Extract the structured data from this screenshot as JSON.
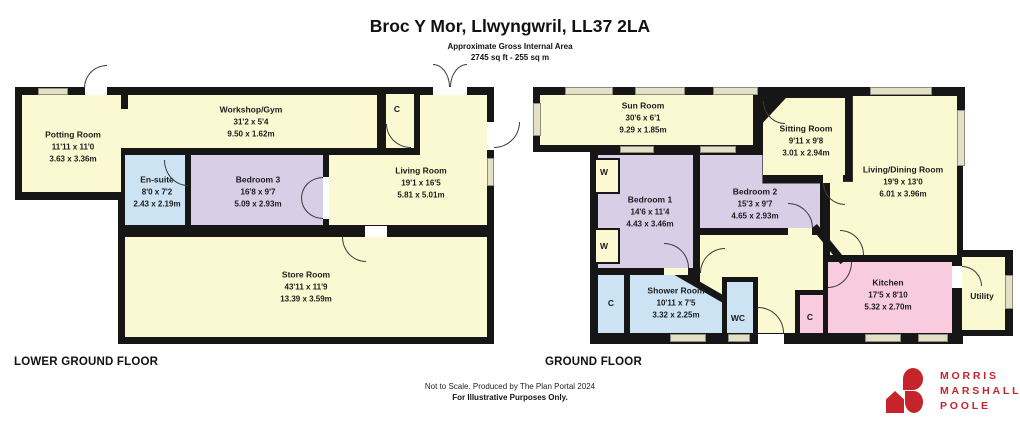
{
  "title": "Broc Y Mor, Llwyngwril, LL37 2LA",
  "subtitle": "Approximate Gross Internal Area",
  "area": "2745 sq ft - 255 sq m",
  "floors": {
    "lower": {
      "label": "LOWER GROUND FLOOR",
      "rooms": {
        "potting": {
          "name": "Potting Room",
          "imperial": "11'11 x 11'0",
          "metric": "3.63 x 3.36m"
        },
        "workshop": {
          "name": "Workshop/Gym",
          "imperial": "31'2 x 5'4",
          "metric": "9.50 x 1.62m"
        },
        "ensuite": {
          "name": "En-suite",
          "imperial": "8'0 x 7'2",
          "metric": "2.43 x 2.19m"
        },
        "bedroom3": {
          "name": "Bedroom 3",
          "imperial": "16'8 x 9'7",
          "metric": "5.09 x 2.93m"
        },
        "living": {
          "name": "Living Room",
          "imperial": "19'1 x 16'5",
          "metric": "5.81 x 5.01m"
        },
        "store": {
          "name": "Store Room",
          "imperial": "43'11 x 11'9",
          "metric": "13.39 x 3.59m"
        },
        "cupboard": {
          "name": "C"
        }
      }
    },
    "ground": {
      "label": "GROUND FLOOR",
      "rooms": {
        "sunroom": {
          "name": "Sun Room",
          "imperial": "30'6 x 6'1",
          "metric": "9.29 x 1.85m"
        },
        "sitting": {
          "name": "Sitting Room",
          "imperial": "9'11 x 9'8",
          "metric": "3.01 x 2.94m"
        },
        "livingdining": {
          "name": "Living/Dining Room",
          "imperial": "19'9 x 13'0",
          "metric": "6.01 x 3.96m"
        },
        "bedroom1": {
          "name": "Bedroom 1",
          "imperial": "14'6 x 11'4",
          "metric": "4.43 x 3.46m"
        },
        "bedroom2": {
          "name": "Bedroom 2",
          "imperial": "15'3 x 9'7",
          "metric": "4.65 x 2.93m"
        },
        "shower": {
          "name": "Shower Room",
          "imperial": "10'11 x 7'5",
          "metric": "3.32 x 2.25m"
        },
        "kitchen": {
          "name": "Kitchen",
          "imperial": "17'5 x 8'10",
          "metric": "5.32 x 2.70m"
        },
        "utility": {
          "name": "Utility"
        },
        "wc": {
          "name": "WC"
        },
        "wardrobe": {
          "name": "W"
        },
        "cupboard": {
          "name": "C"
        }
      }
    }
  },
  "footer": {
    "line1": "Not to Scale. Produced by The Plan Portal 2024",
    "line2": "For Illustrative Purposes Only."
  },
  "logo": {
    "line1": "MORRIS",
    "line2": "MARSHALL",
    "line3": "POOLE"
  },
  "colors": {
    "wall": "#161616",
    "room_yellow": "#FBF9D2",
    "room_blue": "#CBE3F2",
    "room_purple": "#D8CEE6",
    "room_pink": "#F8CBDF",
    "window": "#E4E0C8",
    "logo_red": "#C5242B"
  }
}
